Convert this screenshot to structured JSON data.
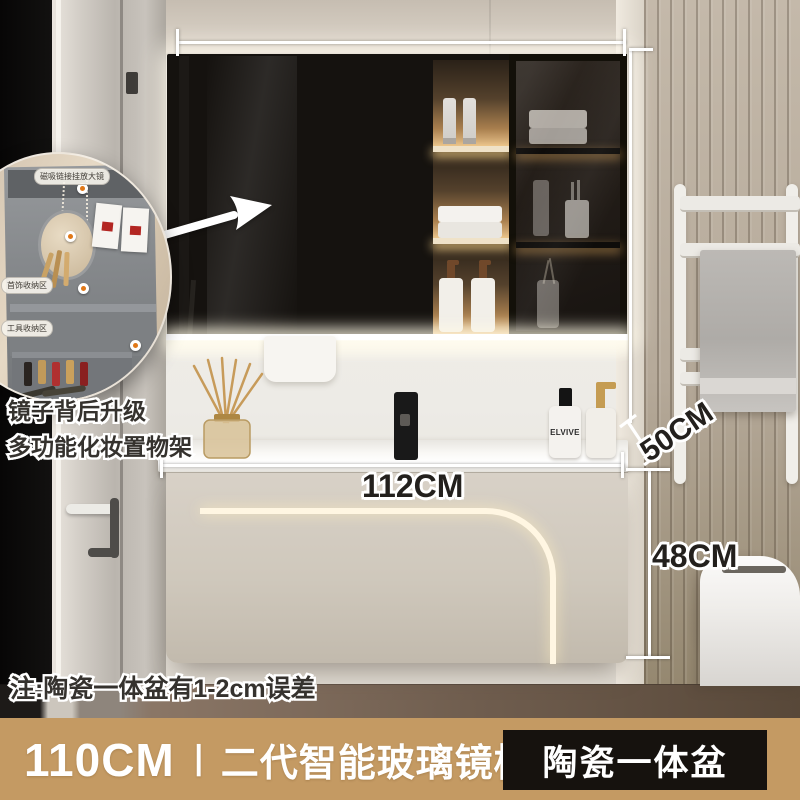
{
  "banner": {
    "size": "110CM",
    "separator": "丨",
    "name": "二代智能玻璃镜柜",
    "tag": "陶瓷一体盆"
  },
  "dimensions": {
    "width": "112CM",
    "depth": "50CM",
    "height": "48CM"
  },
  "callouts": {
    "feature_line1": "镜子背后升级",
    "feature_line2": "多功能化妆置物架",
    "note": "注:陶瓷一体盆有1-2cm误差"
  },
  "inset": {
    "label_top": "磁吸链接挂放大镜",
    "label_jewelry": "首饰收纳区",
    "label_tools": "工具收纳区"
  },
  "products": {
    "shampoo_brand": "ELVIVE"
  },
  "colors": {
    "banner_bg": "#c49a63",
    "tag_bg": "#16120e",
    "led_glow": "#fff6e2",
    "cabinet_body": "#cfc8bc",
    "slat_wall": "#b5a999"
  }
}
